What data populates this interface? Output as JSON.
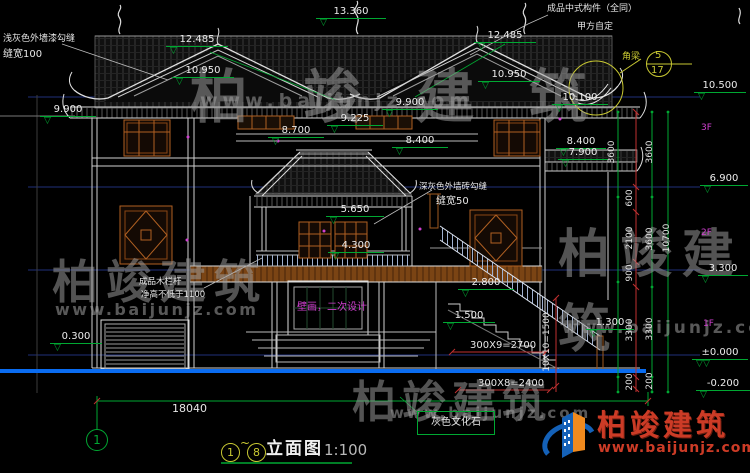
{
  "icons": {
    "level_triangle": "▽"
  },
  "colors": {
    "accent_green": "#00a832",
    "dim_red": "#c03030",
    "window_brown": "#b06022",
    "ground_blue": "#0a6cf0",
    "highlight_magenta": "#d040d0",
    "detail_yellow": "#c8c832",
    "watermark_orange": "#cc3b26"
  },
  "watermark": {
    "brand": "柏竣建筑",
    "url": "www.baijunjz.com"
  },
  "logo": {
    "brand": "柏竣建筑",
    "url": "www.baijunjz.com"
  },
  "title_block": {
    "axis_from": "1",
    "tilde": "~",
    "axis_to": "8",
    "name": "立面图",
    "scale": "1:100"
  },
  "axis": {
    "grid_1": "1"
  },
  "notes": {
    "paint_line1": "浅灰色外墙漆勾缝",
    "paint_line2": "缝宽100",
    "component_line1": "成品中式构件（全同）",
    "component_line2": "甲方自定",
    "corner_beam": "角梁",
    "detail_no": "5",
    "detail_sheet": "17",
    "brick_line1": "深灰色外墙砖勾缝",
    "brick_line2": "缝宽50",
    "railing_line1": "成品木栏杆",
    "railing_line2": "净高不低于1100",
    "mural": "壁画，二次设计",
    "stone": "灰色文化石"
  },
  "floors": {
    "f3": "3F",
    "f2": "2F",
    "f1": "1F"
  },
  "elev": [
    "13.360",
    "12.485",
    "10.950",
    "9.900",
    "12.485",
    "10.950",
    "10.100",
    "10.500",
    "9.900",
    "9.225",
    "8.700",
    "8.400",
    "8.400",
    "7.900",
    "6.900",
    "5.650",
    "4.300",
    "3.300",
    "2.800",
    "1.500",
    "1.300",
    "±0.000",
    "-0.200",
    "0.300"
  ],
  "dims": {
    "col_a": [
      "3600",
      "600",
      "2100",
      "900",
      "3300",
      "200"
    ],
    "col_b": [
      "3600",
      "3600",
      "3300",
      "200"
    ],
    "total_height": "10700",
    "total_width": "18040",
    "steps_upper": "300X9=2700",
    "steps_lower": "300X8=2400",
    "steps_vert": "10X10=1500"
  }
}
